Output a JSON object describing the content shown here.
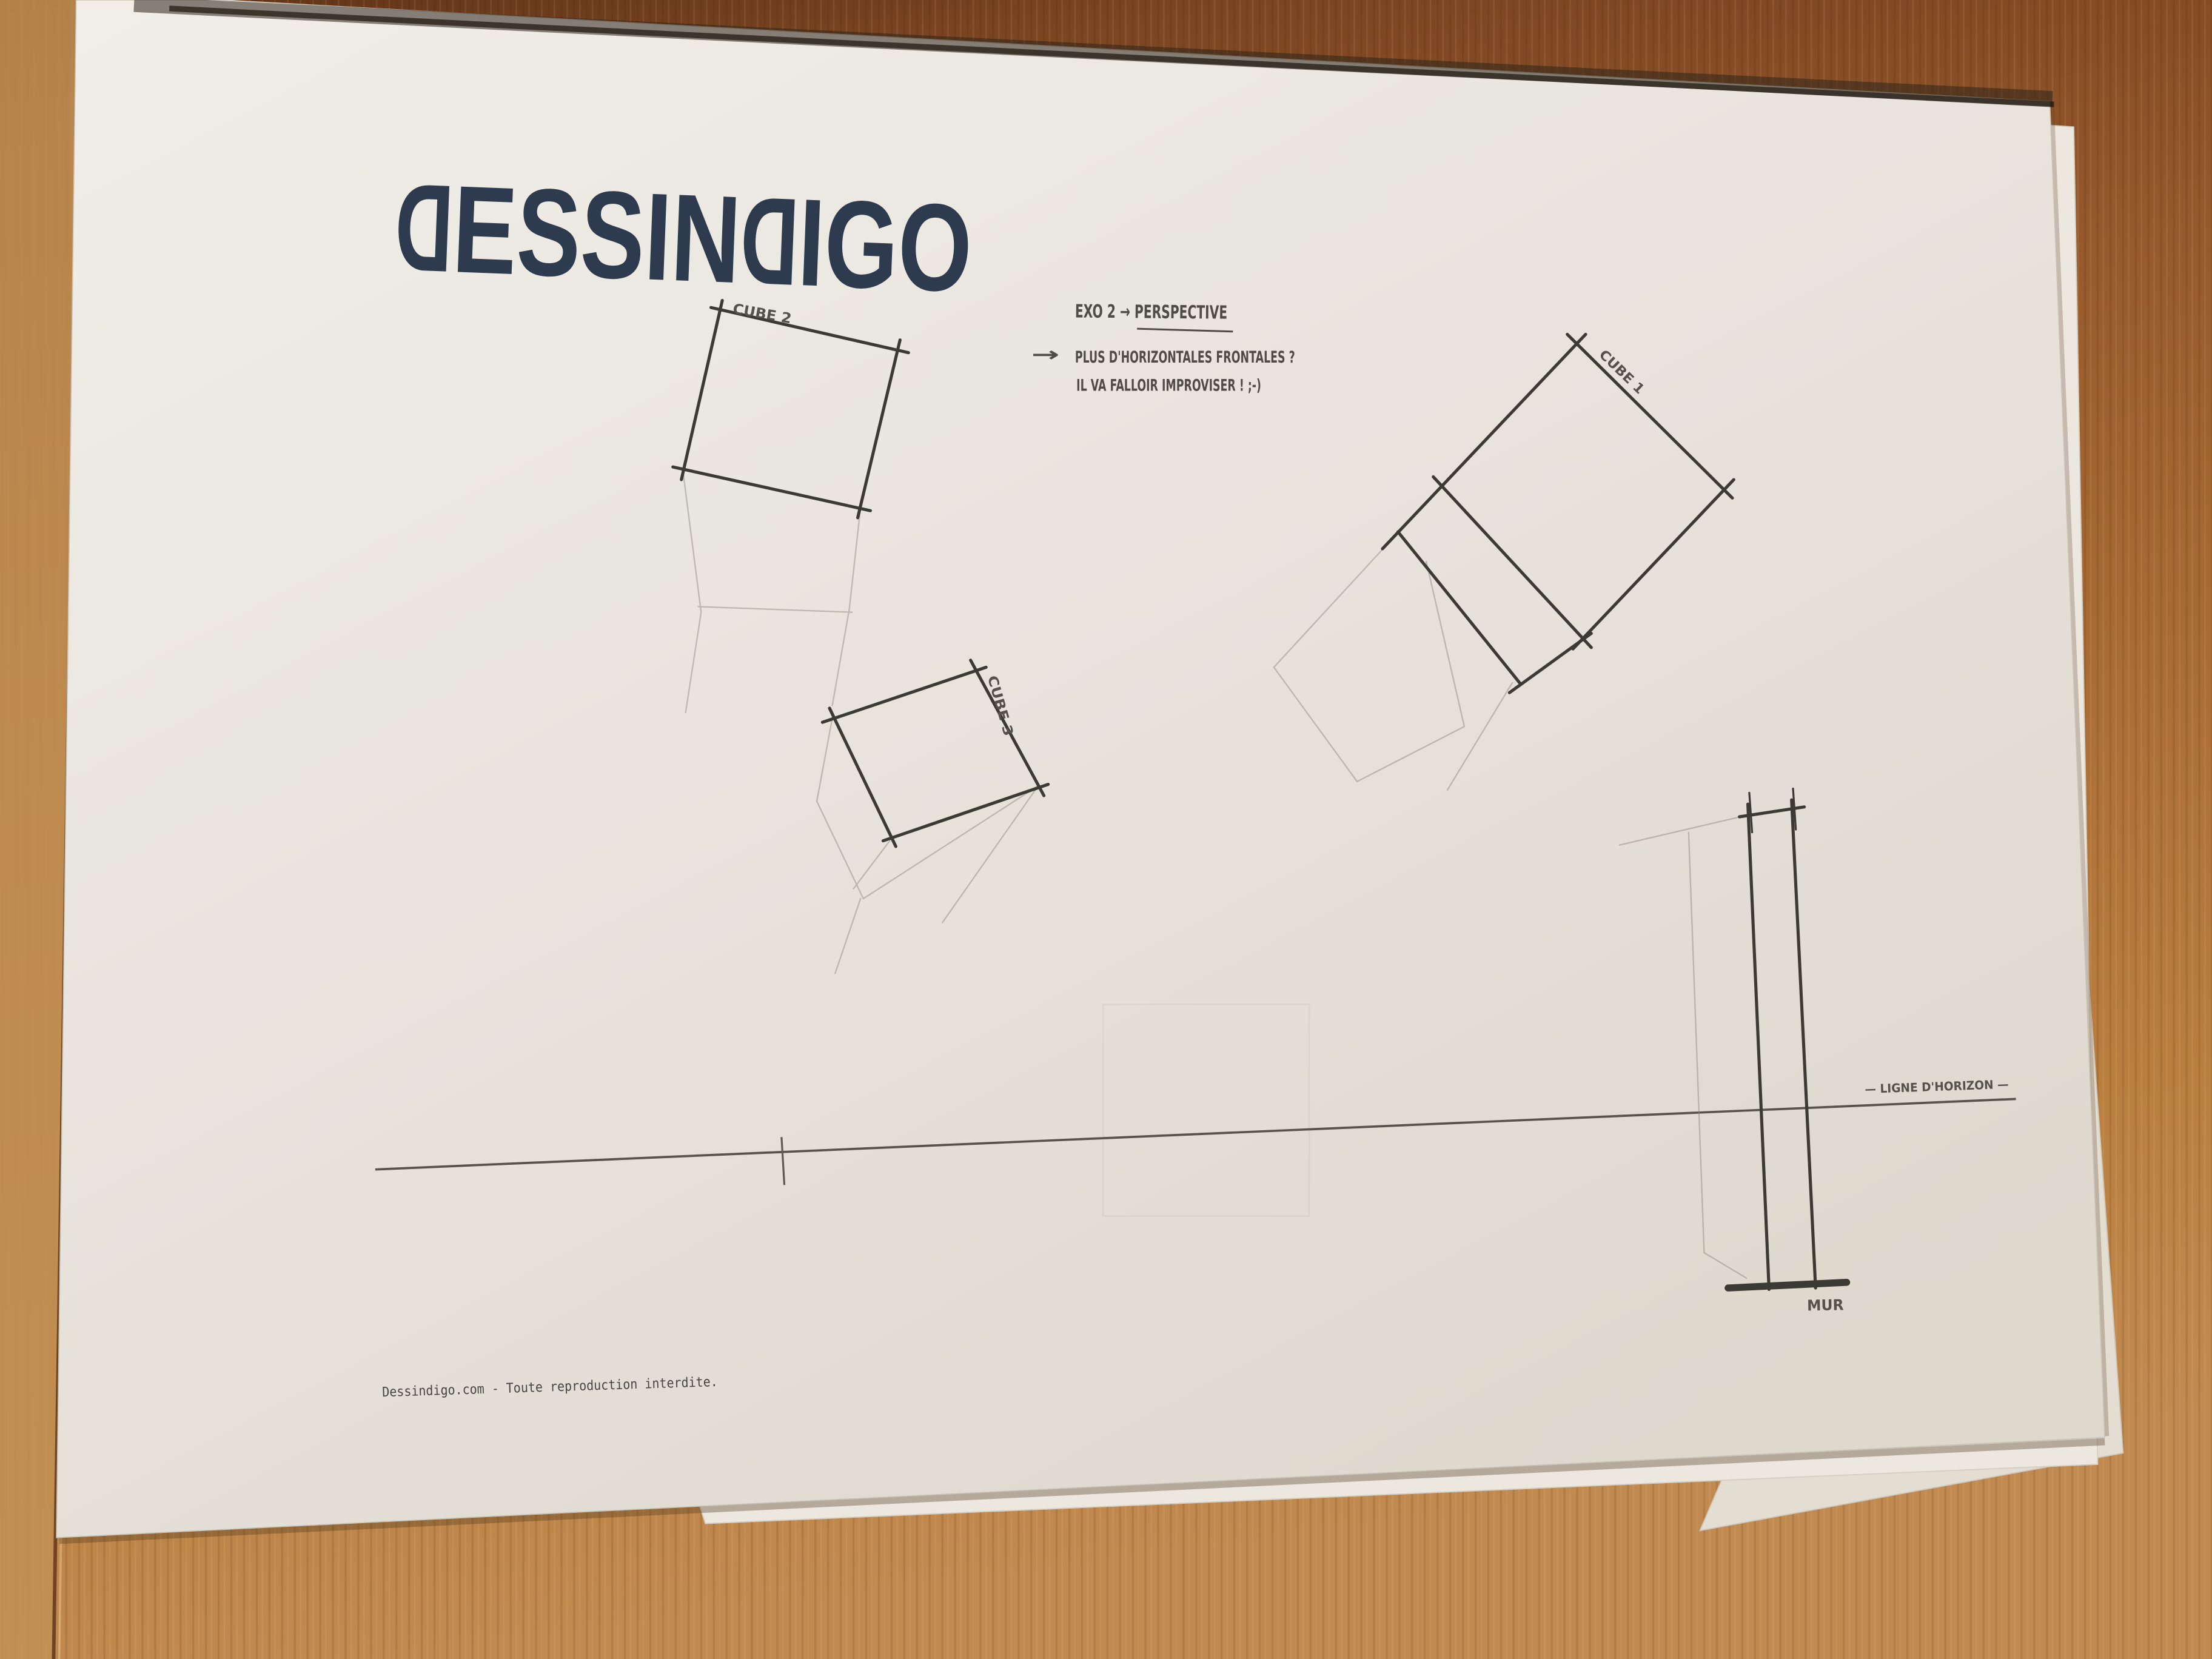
{
  "paper": {
    "logo": {
      "first_d": "D",
      "essin": "ESSIN",
      "second_d": "D",
      "igo": "IGO"
    },
    "notes": {
      "title": "EXO 2 → PERSPECTIVE",
      "arrow": "→",
      "question": "PLUS D'HORIZONTALES FRONTALES ?",
      "answer": "IL VA FALLOIR IMPROVISER !  ;-)"
    },
    "labels": {
      "cube1": "CUBE 1",
      "cube2": "CUBE 2",
      "cube3": "CUBE 3",
      "horizon": "— LIGNE D'HORIZON —",
      "wall": "MUR"
    },
    "footer": "Dessindigo.com - Toute reproduction interdite."
  },
  "colors": {
    "logo_navy": "#2e3b4e",
    "pencil_dark": "#3c3a35",
    "pencil_faint": "#8a8478",
    "wood_brown": "#a96a33",
    "paper_white": "#eae6df"
  }
}
